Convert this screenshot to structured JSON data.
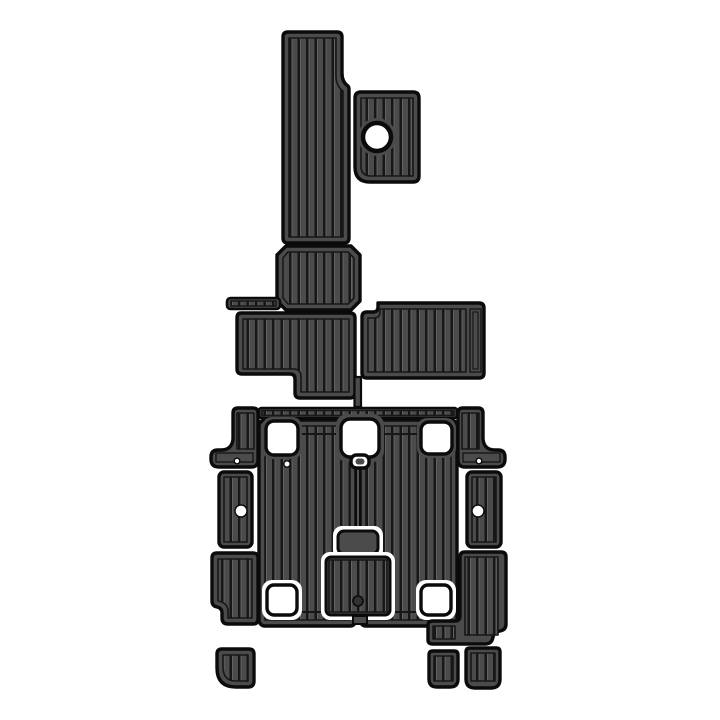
{
  "meta": {
    "description": "Top-down product image of a marine EVA foam teak decking pad kit: dark grey striped boat cockpit and swim platform mats of various interlocking shapes on a white background",
    "background": "#ffffff",
    "piece_count": 19
  },
  "colors": {
    "background": "#ffffff",
    "pad_fill": "#4b4b4b",
    "stripe": "#171717",
    "outline": "#0b0b0b",
    "plank_highlight": "#666666",
    "cutout": "#ffffff",
    "hatch_dot": "#323232"
  },
  "pieces": [
    {
      "id": "bow-column-pad",
      "shape": "tall L-shaped runner with small right step"
    },
    {
      "id": "side-tab-pad",
      "shape": "rounded rectangle with circular cup-holder cutout"
    },
    {
      "id": "helm-step-pad",
      "shape": "chamfered rectangle below bow runner"
    },
    {
      "id": "left-tab-strip",
      "shape": "small horizontal striped strip"
    },
    {
      "id": "mid-left-pad",
      "shape": "L-shaped pad stepping down to the right"
    },
    {
      "id": "mid-right-pad",
      "shape": "wide rectangle with notched top-left corner and plain end plank"
    },
    {
      "id": "connector-stick",
      "shape": "thin vertical joiner"
    },
    {
      "id": "transom-top-strip",
      "shape": "long thin striped edging strip"
    },
    {
      "id": "left-wing-pad",
      "shape": "boomerang corner piece with locator dot"
    },
    {
      "id": "right-wing-pad",
      "shape": "mirrored boomerang corner piece with locator dot"
    },
    {
      "id": "cockpit-floor-left-half",
      "shape": "large striped floor panel with square cutouts"
    },
    {
      "id": "cockpit-floor-right-half",
      "shape": "large striped floor panel with square cutouts"
    },
    {
      "id": "center-hatch-small",
      "shape": "white-rimmed small hatch insert"
    },
    {
      "id": "center-hatch-large",
      "shape": "white-rimmed striped hatch insert with drain dot"
    },
    {
      "id": "left-upper-side-pad",
      "shape": "narrow vertical pad with round cutout"
    },
    {
      "id": "left-lower-side-pad",
      "shape": "vertical pad with notched bottom-left corner"
    },
    {
      "id": "right-upper-side-pad",
      "shape": "narrow vertical pad with round cutout"
    },
    {
      "id": "right-lower-side-pad",
      "shape": "L-shaped pad with scalloped corner and left foot"
    },
    {
      "id": "small-step-pads",
      "shape": "three small rounded step pads along the bottom"
    }
  ]
}
